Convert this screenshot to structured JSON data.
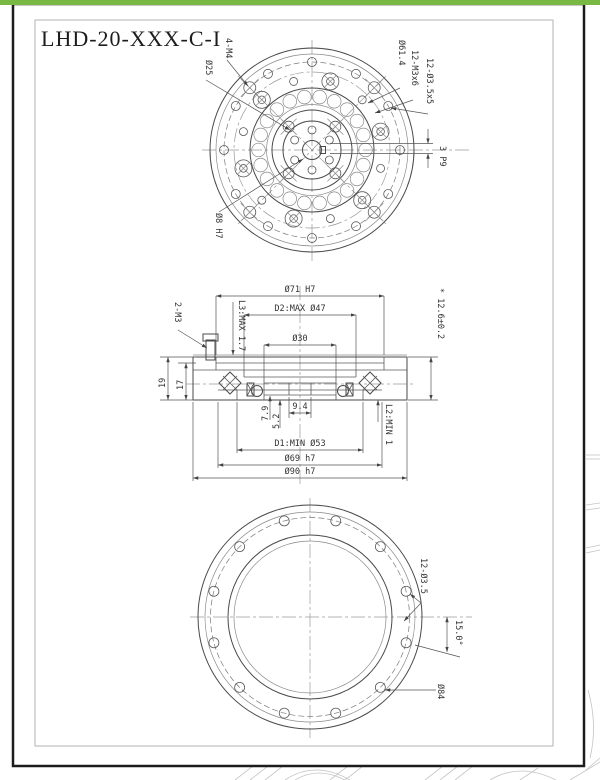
{
  "title": "LHD-20-XXX-C-I",
  "colors": {
    "accent_green": "#79b843",
    "frame": "#1c1c1c",
    "line": "#4a4a4a",
    "centerline": "#9a9a9a"
  },
  "top_view": {
    "bolt_label": "4-M4",
    "hub_dia": "Ø25",
    "bc_dia": "Ø61.4",
    "screws": "12-M3x6",
    "holes": "12-Ø3.5x5",
    "keyway": "3 P9",
    "bore": "Ø8 H7"
  },
  "section_view": {
    "od_top": "Ø71 H7",
    "d2": "D2:MAX Ø47",
    "d30": "Ø30",
    "width": "* 12.6±0.2",
    "l3": "L3:MAX 1.7",
    "screw": "2-M3",
    "h19": "19",
    "h17": "17",
    "w94": "9.4",
    "h79": "7.9",
    "h52": "5.2",
    "d1": "D1:MIN Ø53",
    "d69": "Ø69 h7",
    "d90": "Ø90 h7",
    "l2": "L2:MIN 1"
  },
  "bottom_view": {
    "holes": "12-Ø3.5",
    "angle": "15.0°",
    "bc": "Ø84"
  }
}
